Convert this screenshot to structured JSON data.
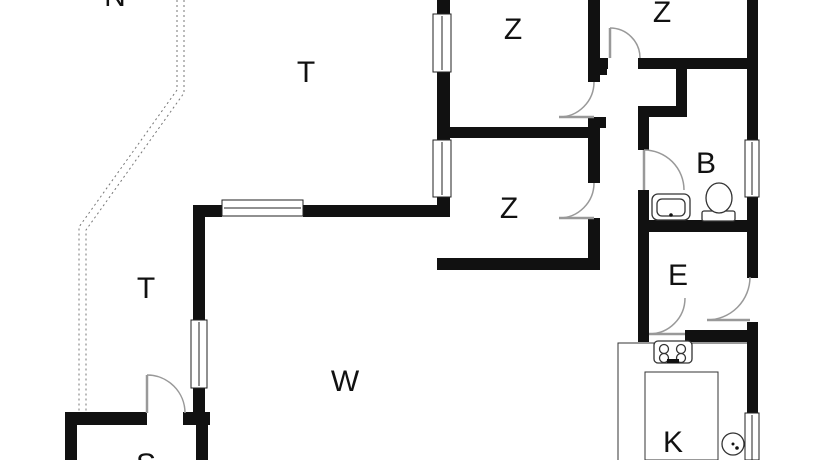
{
  "document_type": "floor-plan",
  "labels": [
    {
      "id": "bedroom-1",
      "text": "Z"
    },
    {
      "id": "bedroom-2",
      "text": "Z"
    },
    {
      "id": "bedroom-3",
      "text": "Z"
    },
    {
      "id": "bathroom",
      "text": "B"
    },
    {
      "id": "entry",
      "text": "E"
    },
    {
      "id": "living-room",
      "text": "W"
    },
    {
      "id": "kitchen",
      "text": "K"
    },
    {
      "id": "terrace-top",
      "text": "T"
    },
    {
      "id": "terrace-left",
      "text": "T"
    },
    {
      "id": "room-partial-bottom",
      "text": "S"
    },
    {
      "id": "label-partial-top",
      "text": "N"
    }
  ],
  "fixtures": [
    "bathroom-sink",
    "toilet",
    "stove",
    "kitchen-island",
    "kitchen-sink"
  ],
  "colors": {
    "background": "#ffffff",
    "walls": "#111111",
    "door_swing": "#999999",
    "terrace_boundary": "#777777",
    "text": "#111111"
  }
}
